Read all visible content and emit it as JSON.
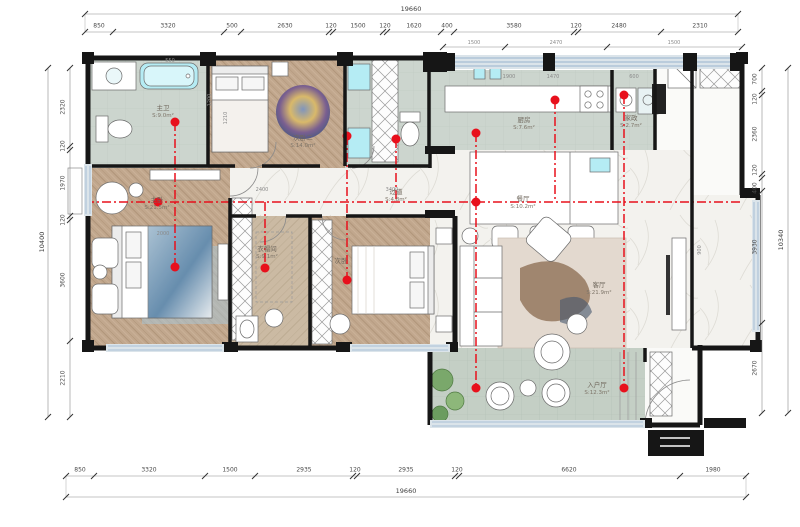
{
  "dims": {
    "top_total": "19660",
    "top": [
      "850",
      "3320",
      "500",
      "2630",
      "120",
      "1500",
      "120",
      "1620",
      "400",
      "3580",
      "120",
      "2480",
      "2310"
    ],
    "top_sub": [
      "1500",
      "2470",
      "1500"
    ],
    "bottom": [
      "850",
      "3320",
      "1500",
      "2935",
      "120",
      "2935",
      "120",
      "6620",
      "1980"
    ],
    "bottom_total": "19660",
    "left": [
      "2320",
      "120",
      "1970",
      "120",
      "3600",
      "2210"
    ],
    "left_total": "10400",
    "right": [
      "700",
      "120",
      "2360",
      "120",
      "400",
      "3930",
      "2670"
    ],
    "right_total": "10340",
    "interior": [
      "550",
      "1200",
      "1900",
      "1470",
      "600",
      "2400",
      "3400",
      "2000",
      "900",
      "1210"
    ]
  },
  "rooms": [
    {
      "name": "主卫",
      "area": "S:9.0m²"
    },
    {
      "name": "次卧二",
      "area": "S:14.0m²"
    },
    {
      "name": "厨房",
      "area": "S:7.6m²"
    },
    {
      "name": "家政",
      "area": "S:2.7m²"
    },
    {
      "name": "过道",
      "area": "S:4.8m²"
    },
    {
      "name": "餐厅",
      "area": "S:10.2m²"
    },
    {
      "name": "客厅",
      "area": "S:21.9m²"
    },
    {
      "name": "入户厅",
      "area": "S:12.3m²"
    },
    {
      "name": "主卧",
      "area": "S:21.5m²"
    },
    {
      "name": "衣帽间",
      "area": "S:9.1m²"
    },
    {
      "name": "次卧",
      "area": ""
    }
  ],
  "colors": {
    "wall": "#161616",
    "centerline_red": "#e8101c",
    "tile_sage": "#ccd5ce",
    "wood": "#c1a78d",
    "marble": "#f3f2ee",
    "fixture_cyan": "#b5ecf4",
    "window_blue": "#9ab4cf"
  }
}
